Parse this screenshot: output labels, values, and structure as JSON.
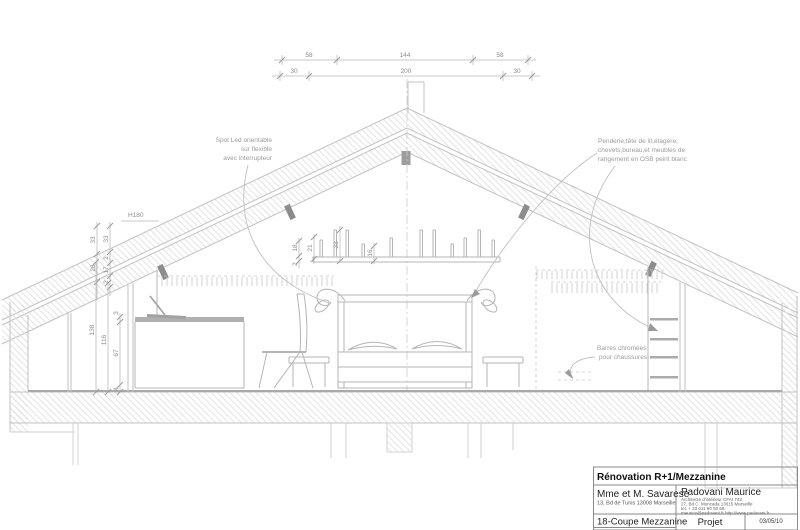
{
  "dimensions": {
    "top_row1": {
      "left": "58",
      "middle": "144",
      "right": "58"
    },
    "top_row2": {
      "left": "30",
      "middle": "200",
      "right": "30"
    },
    "roof_left_outer": {
      "a": "33",
      "b": "28"
    },
    "roof_left_inner": {
      "a": "33",
      "b": "2",
      "c": "17",
      "d": "2"
    },
    "left_heights": {
      "overall": "138",
      "interior": "116",
      "desk_top": "3",
      "desk_height": "67",
      "base": "4"
    },
    "shelf": {
      "gap": "18",
      "board": "2",
      "compartment": "21",
      "height": "33",
      "depth": "16"
    },
    "height_marker": "H180"
  },
  "annotations": {
    "spot_led": {
      "line1": "Spot Led orientable",
      "line2": "sur flexible",
      "line3": "avec interrupteur"
    },
    "storage": {
      "line1": "Penderie,tête de lit,étagère,",
      "line2": "chevets,bureau,et meubles de",
      "line3": "rangement en OSB peint blanc"
    },
    "shoe_bars": {
      "line1": "Barres chromées",
      "line2": "pour chaussures"
    }
  },
  "title_block": {
    "project": "Rénovation R+1/Mezzanine",
    "client": "Mme et M. Savarese",
    "client_address": "13, Bd de Tunis 13008 Marseille",
    "architect": "Padovani Maurice",
    "architect_line1": "Architecte d'intérieur CFAI 743",
    "architect_line2": "27, Bd C. Moncada 13015 Marseille",
    "architect_line3": "tel. + 33 611 90 50 69.",
    "architect_line4": "maurice@padovani.fr   http://www.padovani.fr",
    "sheet": "18-Coupe Mezzanine",
    "phase": "Projet",
    "date": "03/05/10"
  },
  "colors": {
    "line_gray": "#c2c2c2",
    "hatch_gray": "#e0e0e0",
    "dim_text": "#8c8c8c",
    "spot_fill": "#8c8c8c",
    "title_text": "#111111"
  }
}
